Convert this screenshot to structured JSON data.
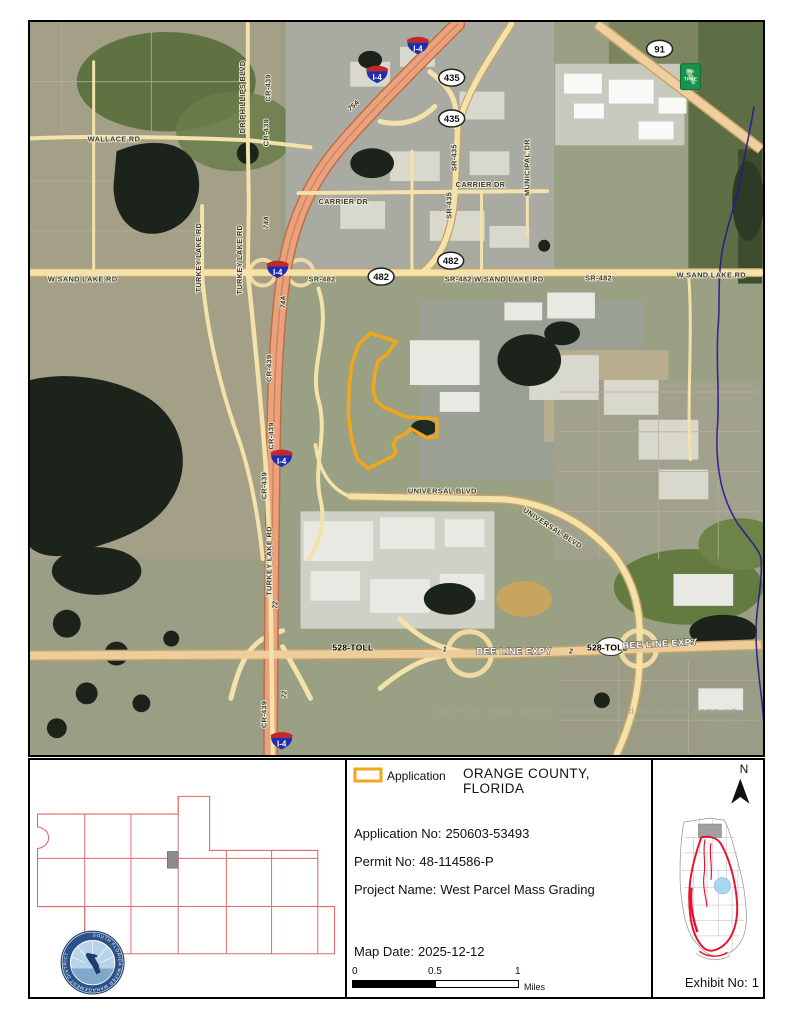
{
  "exhibit": {
    "county_title": "ORANGE COUNTY, FLORIDA",
    "legend": {
      "application_label": "Application"
    },
    "details": [
      {
        "label": "Application No:",
        "value": "250603-53493"
      },
      {
        "label": "Permit No:",
        "value": "48-114586-P"
      },
      {
        "label": "Project Name:",
        "value": "West Parcel Mass Grading"
      }
    ],
    "map_date": {
      "label": "Map Date:",
      "value": "2025-12-12"
    },
    "scale_bar": {
      "start": "0",
      "middle": "0.5",
      "end": "1",
      "unit": "Miles"
    },
    "north_label": "N",
    "exhibit_no": {
      "label": "Exhibit No:",
      "value": "1"
    }
  },
  "map": {
    "attribution_line1": "Source: Esri, Maxar, Earthstar Geographics, and the GIS User Community,",
    "attribution_line2": "NAVTEQ",
    "labels": {
      "dr_phillips_blvd": "DR PHILLIPS BLVD",
      "wallace_rd": "WALLACE RD",
      "cr_439": "CR-439",
      "turkey_lake_rd": "TURKEY LAKE RD",
      "carrier_dr": "CARRIER DR",
      "municipal_dr": "MUNICIPAL DR",
      "sr_435": "SR-435",
      "sr_482": "SR-482",
      "w_sand_lake_rd": "W SAND LAKE RD",
      "sr_482_w_sand_lake_rd": "SR-482  W SAND LAKE RD",
      "universal_blvd": "UNIVERSAL BLVD",
      "bee_line_expy": "BEE LINE EXPY",
      "toll_528": "528-TOLL",
      "exit_72": "72",
      "exit_74a": "74A",
      "exit_75a": "75A",
      "ramp_1": "1",
      "ramp_2": "2"
    },
    "shields": {
      "interstate_4": "I-4",
      "route_435": "435",
      "route_482": "482",
      "route_91": "91",
      "fl_tpke_line1": "FL",
      "fl_tpke_line2": "TPKE"
    }
  },
  "logo": {
    "district_name": "SOUTH FLORIDA WATER MANAGEMENT DISTRICT"
  },
  "colors": {
    "application_outline": "#F2A71B",
    "district_boundary_red": "#E8112D",
    "water_boundary_purple": "#2E1691"
  }
}
